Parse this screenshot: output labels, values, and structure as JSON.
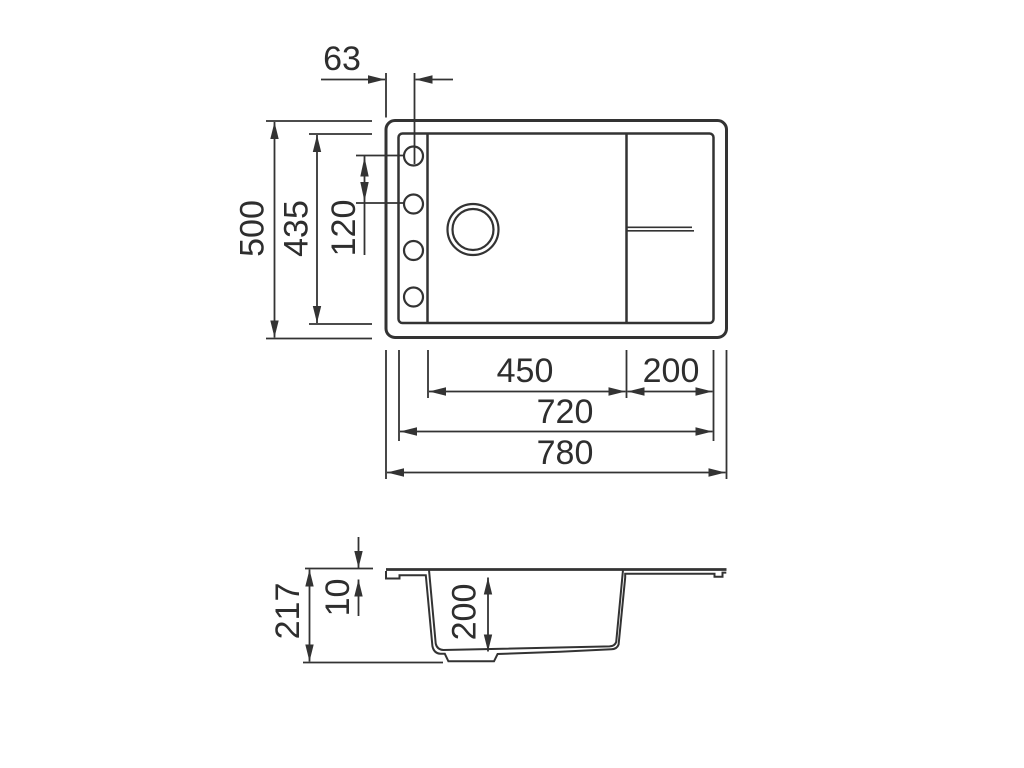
{
  "drawing": {
    "kind": "sink-dimension-drawing",
    "units": "mm",
    "top_view": {
      "hole_offset_x": "63",
      "overall_depth": "500",
      "inner_depth": "435",
      "hole_spacing": "120",
      "bowl_width": "450",
      "drainboard_width": "200",
      "inner_width": "720",
      "overall_width": "780"
    },
    "section_view": {
      "overall_height": "217",
      "rim_thickness": "10",
      "bowl_depth": "200"
    }
  },
  "colors": {
    "background": "#ffffff",
    "line": "#333333",
    "text": "#2e2e2e"
  }
}
